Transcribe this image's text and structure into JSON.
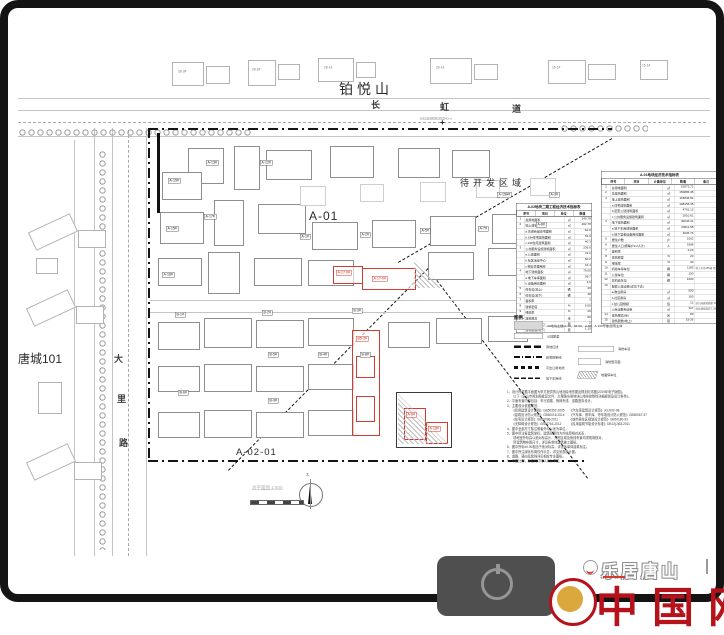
{
  "map": {
    "neighborhood_top": "铂悦山",
    "neighbor_left": "唐城101",
    "pending_area": "待开发区域",
    "plot_a01": "A-01",
    "plot_a0201": "A-02-01",
    "road_top_annotation": "长虹道(规划红线宽40m)",
    "road_top_chars": [
      {
        "t": "长",
        "x": 371,
        "y": 98
      },
      {
        "t": "虹",
        "x": 440,
        "y": 100
      },
      {
        "t": "道",
        "x": 512,
        "y": 102
      }
    ],
    "road_left_chars": [
      {
        "t": "大",
        "x": 114,
        "y": 352
      },
      {
        "t": "里",
        "x": 117,
        "y": 392
      },
      {
        "t": "路",
        "x": 119,
        "y": 436
      }
    ],
    "north_tags": [
      {
        "t": "28-3#",
        "x": 178,
        "y": 70
      },
      {
        "t": "28-2#",
        "x": 252,
        "y": 68
      },
      {
        "t": "28-1#",
        "x": 324,
        "y": 66
      },
      {
        "t": "29-1#",
        "x": 436,
        "y": 66
      },
      {
        "t": "16-1#",
        "x": 552,
        "y": 66
      },
      {
        "t": "15-1#",
        "x": 642,
        "y": 64
      }
    ],
    "building_tags": [
      {
        "t": "A-15A#",
        "x": 497,
        "y": 192
      },
      {
        "t": "A-3#",
        "x": 549,
        "y": 192
      },
      {
        "t": "A-15#",
        "x": 168,
        "y": 178
      },
      {
        "t": "A-13#",
        "x": 206,
        "y": 160
      },
      {
        "t": "A-12#",
        "x": 260,
        "y": 160
      },
      {
        "t": "A-17#",
        "x": 204,
        "y": 214
      },
      {
        "t": "A-15#",
        "x": 166,
        "y": 226
      },
      {
        "t": "A-16#",
        "x": 162,
        "y": 272
      },
      {
        "t": "A-1#",
        "x": 300,
        "y": 234
      },
      {
        "t": "A-2#",
        "x": 360,
        "y": 232
      },
      {
        "t": "A-5#",
        "x": 420,
        "y": 228
      },
      {
        "t": "A-7#",
        "x": 478,
        "y": 226
      },
      {
        "t": "A-8#",
        "x": 536,
        "y": 222
      },
      {
        "t": "B-1#",
        "x": 175,
        "y": 312
      },
      {
        "t": "B-2#",
        "x": 262,
        "y": 310
      },
      {
        "t": "B-3#",
        "x": 352,
        "y": 308
      },
      {
        "t": "B-5#",
        "x": 268,
        "y": 352
      },
      {
        "t": "B-8#",
        "x": 360,
        "y": 352
      },
      {
        "t": "B-6#",
        "x": 178,
        "y": 390
      },
      {
        "t": "B-9#",
        "x": 268,
        "y": 398
      },
      {
        "t": "B-4#",
        "x": 318,
        "y": 352
      }
    ],
    "red_tags": [
      {
        "t": "A-17-0#",
        "x": 336,
        "y": 270
      },
      {
        "t": "A-17-0#",
        "x": 372,
        "y": 276
      },
      {
        "t": "B5-3#",
        "x": 356,
        "y": 336
      },
      {
        "t": "A-8#",
        "x": 406,
        "y": 412
      },
      {
        "t": "A-18#",
        "x": 428,
        "y": 426
      }
    ],
    "scale_label": "总平面图 1:500",
    "north_label": "北"
  },
  "panel": {
    "table_left": {
      "title": "A-02地块二期工程经济技术指标表",
      "headers": [
        "序号",
        "项目",
        "单位",
        "数值"
      ],
      "rows": [
        [
          "1",
          "总用地面积",
          "㎡",
          "249.78"
        ],
        [
          "2",
          "地上建筑面积",
          "㎡",
          "202.78"
        ],
        [
          "",
          "a.普通商品住宅面积",
          "㎡",
          "62.9"
        ],
        [
          "",
          "b.18#住宅建筑面积",
          "㎡",
          "53.9"
        ],
        [
          "",
          "c.19#住宅建筑面积",
          "㎡",
          "40.3"
        ],
        [
          "3",
          "公共服务设施建筑面积",
          "㎡",
          "236.6"
        ],
        [
          "",
          "a.公建面积",
          "㎡",
          "41.2"
        ],
        [
          "",
          "b.社区活动中心",
          "㎡",
          "60.2"
        ],
        [
          "",
          "c.物业管理用房",
          "㎡",
          "16.4"
        ],
        [
          "4",
          "地下建筑面积",
          "㎡",
          "79.05"
        ],
        [
          "",
          "a.地下车库面积",
          "㎡",
          "59.7"
        ],
        [
          "",
          "b.设备用房面积",
          "㎡",
          "3.9"
        ],
        [
          "5",
          "停车位(地上)",
          "辆",
          "29"
        ],
        [
          "6",
          "停车位(地下)",
          "辆",
          "48"
        ],
        [
          "7",
          "容积率",
          "",
          "2"
        ],
        [
          "8",
          "建筑密度",
          "%",
          "6.95"
        ],
        [
          "9",
          "绿地率",
          "%",
          "29"
        ],
        [
          "10",
          "建筑限高",
          "米",
          "80"
        ],
        [
          "11",
          "建筑层数(地上)",
          "层",
          "2"
        ],
        [
          "12",
          "建筑层数(地下)",
          "层",
          "1.15"
        ]
      ]
    },
    "table_right": {
      "title": "A-01地块经济技术指标表",
      "headers": [
        "序号",
        "项目",
        "计量单位",
        "数值",
        "备注"
      ],
      "rows": [
        [
          "1",
          "总用地面积",
          "㎡",
          "51872.71",
          ""
        ],
        [
          "2",
          "总建筑面积",
          "㎡",
          "150886.38",
          ""
        ],
        [
          "3",
          "地上建筑面积",
          "㎡",
          "115846.84",
          ""
        ],
        [
          "",
          "a.住宅建筑面积",
          "㎡",
          "108156.35",
          ""
        ],
        [
          "",
          "b.配套公建建筑面积",
          "㎡",
          "4701.12",
          ""
        ],
        [
          "",
          "c.公共服务设施建筑面积",
          "㎡",
          "2910.61",
          ""
        ],
        [
          "4",
          "地下建筑面积",
          "㎡",
          "40246.31",
          ""
        ],
        [
          "",
          "a.地下车库建筑面积",
          "㎡",
          "34911.98",
          ""
        ],
        [
          "",
          "b.地下室和设备用房面积",
          "㎡",
          "4036.76",
          ""
        ],
        [
          "5",
          "居住户数",
          "户",
          "1062",
          ""
        ],
        [
          "6",
          "居住人口(按每户3.2人计)",
          "人",
          "3398",
          ""
        ],
        [
          "7",
          "容积率",
          "",
          "2.23",
          ""
        ],
        [
          "8",
          "建筑密度",
          "%",
          "20",
          ""
        ],
        [
          "9",
          "绿地率",
          "%",
          "30",
          ""
        ],
        [
          "10",
          "机动车停车位",
          "辆",
          "1183",
          "地上车位255辆 地下车位928辆"
        ],
        [
          "11",
          "公建车位",
          "辆",
          "100",
          ""
        ],
        [
          "12",
          "非机动车位",
          "辆",
          "1600",
          ""
        ],
        [
          "13",
          "配套公建设施(详见下表)",
          "",
          "",
          ""
        ],
        [
          "",
          "a.物业用房",
          "㎡",
          "500",
          ""
        ],
        [
          "",
          "b.社区用房",
          "㎡",
          "160",
          ""
        ],
        [
          "",
          "c.幼儿园规模",
          "班",
          "12",
          "幼儿园建筑面积 3120.6㎡"
        ],
        [
          "",
          "d.商业服务设施",
          "㎡",
          "327",
          "商业建筑面积 1.08万㎡ 详见"
        ],
        [
          "14",
          "建筑限高(米)",
          "米",
          "80",
          ""
        ],
        [
          "15",
          "建筑层数(地上)",
          "层",
          "15-26",
          ""
        ]
      ]
    },
    "legend": {
      "title": "图例.",
      "items_left": [
        {
          "type": "fill",
          "label": "A#地块主楼(A-1#、3#-5#、A-8#、A-16#号楼)建筑主体"
        },
        {
          "type": "empty",
          "label": "公建配套"
        },
        {
          "type": "dash-bold",
          "label": "用地红线"
        },
        {
          "type": "dash-dot",
          "label": "建筑控制线"
        },
        {
          "type": "dash-square",
          "label": "可出让用地线"
        },
        {
          "type": "dash-fine",
          "label": "地下车库线"
        }
      ],
      "items_right": [
        {
          "type": "rect-long",
          "label": "消防车道"
        },
        {
          "type": "rect",
          "label": "消防登高面"
        },
        {
          "type": "hatch",
          "label": "地面停车位"
        }
      ]
    },
    "notes": [
      "1、设计所依据平面图为甲方提供的山地测绘地形图及规划红线图(2019年电子版图)。",
      "　　以下《唐山市规划局批复文件、大里路东侧地块山地块控制性详细规划及设计条件》。",
      "2、平面布置内容包括：车行道路、管网布线、道路竖向设计。",
      "3、主要设计依据规范：",
      "　　《民用建筑设计通则》GB50352-2005　　《汽车库建筑设计规范》JGJ100-98",
      "　　《建筑设计防火规范》GB50016-2014　　《汽车库、修车库、停车场设计防火规范》GB50067-97",
      "　　《住宅设计规范》GB50096-2011　　　　《城市居住区规划设计规范》GB50180-93",
      "　　《无障碍设计规范》GB50763-2012　　　《民用建筑节能设计标准》DB13(J)63-2011",
      "4、图中全部尺寸除注明者外均以米为单位。",
      "5、图中所注各建筑坐标、建筑间距均为外轮廓相对关系，",
      "　　场地室外标高以绝对标高计，开挖区域及管线布置均须现场核对。",
      "　　所建筑物布置尺寸，详见各单体建筑施工图纸。",
      "6、图中所标±0.00相当于绝对标高，详见各单体建筑标注。",
      "7、图中所注绿化布置仅作示意，详见景观设计图。",
      "8、道路、竖向及管线详见相应专业图纸。",
      "9、本图比例，标注尺寸均以米为单位。"
    ]
  },
  "watermark": {
    "text": "乐居唐山",
    "red_brand": "中国网"
  }
}
